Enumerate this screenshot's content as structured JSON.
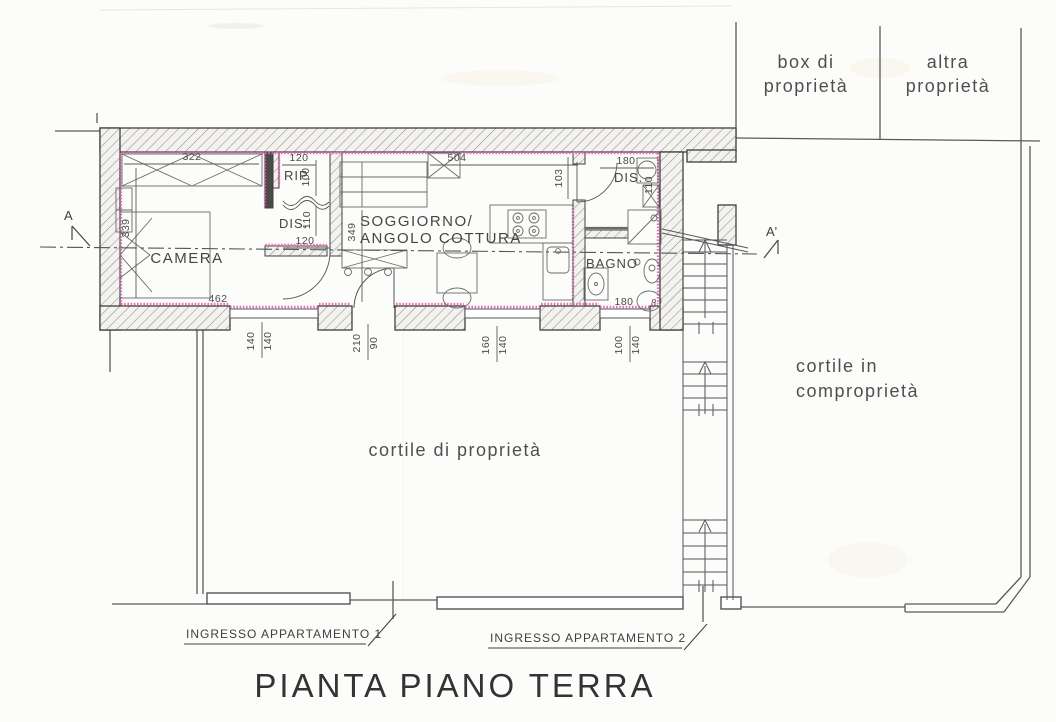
{
  "title": "PIANTA PIANO TERRA",
  "areas": {
    "box_line1": "box di",
    "box_line2": "proprietà",
    "altra_line1": "altra",
    "altra_line2": "proprietà",
    "shared_line1": "cortile in",
    "shared_line2": "comproprietà",
    "private": "cortile di proprietà"
  },
  "rooms": {
    "camera": "CAMERA",
    "soggiorno_line1": "SOGGIORNO/",
    "soggiorno_line2": "ANGOLO COTTURA",
    "bagno": "BAGNO",
    "rip": "RIP.",
    "dis1": "DIS.",
    "dis2": "DIS."
  },
  "dims": {
    "camera_top": "322",
    "camera_left": "339",
    "camera_bottom": "462",
    "rip_top": "120",
    "rip_right": "100",
    "dis1_right": "110",
    "dis1_door": "120",
    "sogg_top": "504",
    "sogg_left": "349",
    "sogg_right": "103",
    "dis2_top": "180",
    "dis2_right": "110",
    "bagno_bottom": "180",
    "win1_left": "140",
    "win1_right": "140",
    "door_left": "210",
    "door_right": "90",
    "win2_left": "160",
    "win2_right": "140",
    "win3_left": "100",
    "win3_right": "140"
  },
  "sections": {
    "a": "A",
    "a_prime": "A'"
  },
  "entrances": {
    "app1": "INGRESSO APPARTAMENTO 1",
    "app2": "INGRESSO APPARTAMENTO 2"
  }
}
